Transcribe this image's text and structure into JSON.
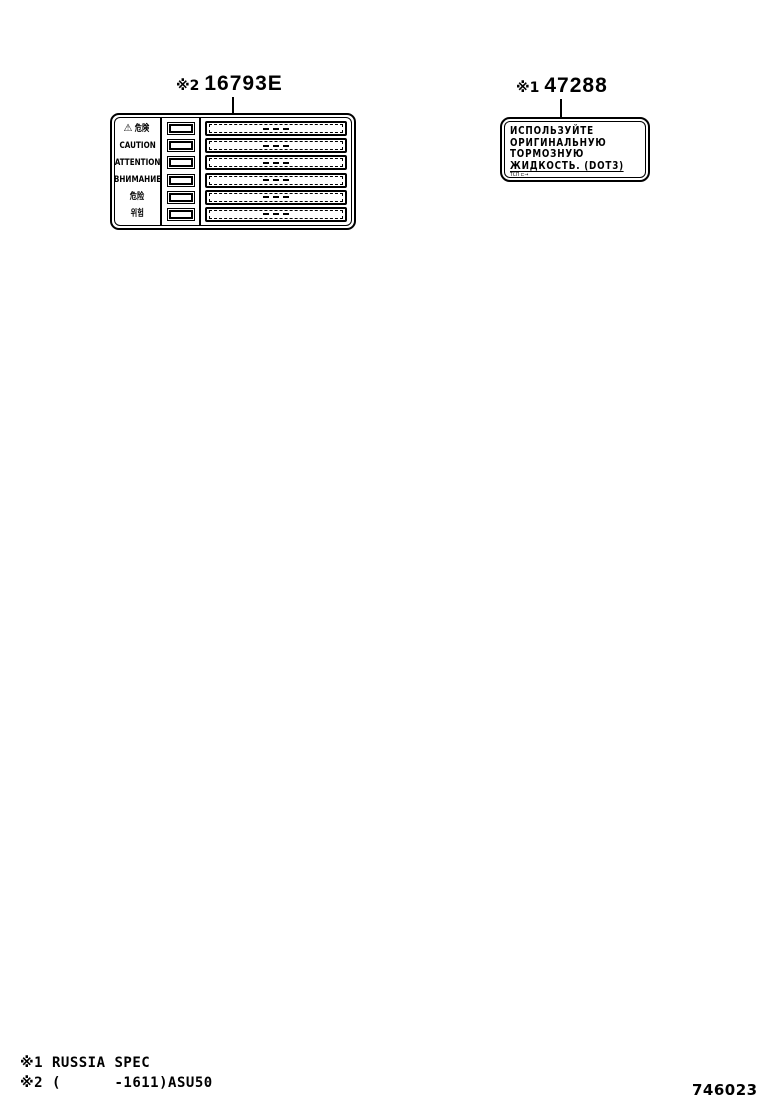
{
  "page": {
    "number": "746023"
  },
  "callouts": {
    "left": {
      "ref": "※2",
      "code": "16793E"
    },
    "right": {
      "ref": "※1",
      "code": "47288"
    }
  },
  "caution_label": {
    "warning_icon": "⚠",
    "rows": [
      {
        "label": "危険"
      },
      {
        "label": "CAUTION"
      },
      {
        "label": "ATTENTION"
      },
      {
        "label": "ВНИМАНИЕ"
      },
      {
        "label": "危险"
      },
      {
        "label": "위험"
      }
    ]
  },
  "brake_fluid_label": {
    "lines": [
      "ИСПОЛЬЗУЙТЕ",
      "ОРИГИНАЛЬНУЮ",
      "ТОРМОЗНУЮ",
      "ЖИДКОСТЬ. (DOT3)"
    ],
    "stamp": "ТСП ⊏→"
  },
  "footnotes": [
    "※1 RUSSIA SPEC",
    "※2 (      -1611)ASU50"
  ],
  "colors": {
    "ink": "#000000",
    "paper": "#ffffff"
  }
}
